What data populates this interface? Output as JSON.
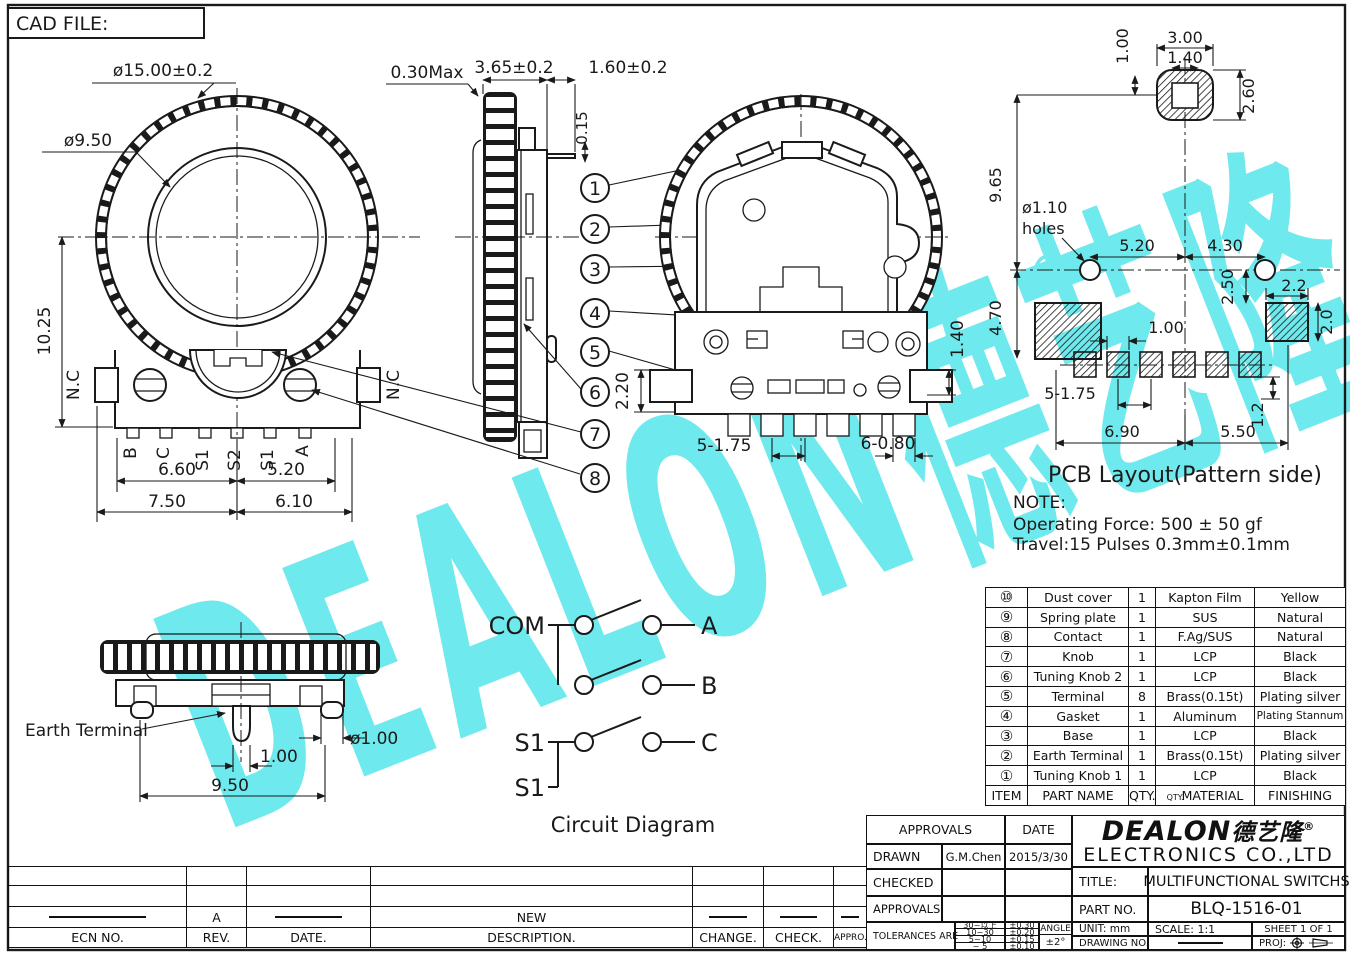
{
  "sheet": {
    "cad_file": "CAD FILE:"
  },
  "watermark": {
    "text": "DEALON德艺隆",
    "registered": "®",
    "color": "#6ee9ed"
  },
  "front_view": {
    "dia_outer": "ø15.00±0.2",
    "dia_inner": "ø9.50",
    "dim_height": "10.25",
    "nc_left": "N.C",
    "nc_right": "N.C",
    "terminals": [
      "B",
      "C",
      "S1",
      "S2",
      "S1",
      "A"
    ],
    "dim_b_left": "6.60",
    "dim_b_right": "5.20",
    "dim_b2_left": "7.50",
    "dim_b2_right": "6.10"
  },
  "side_view": {
    "dim_knob_gap": "0.30Max",
    "dim_thickness": "3.65±0.2",
    "dim_pin_len": "1.60±0.2",
    "dim_pin_off": "0.15"
  },
  "callouts": {
    "c1": "1",
    "c2": "2",
    "c3": "3",
    "c4": "4",
    "c5": "5",
    "c6": "6",
    "c7": "7",
    "c8": "8"
  },
  "back_view": {
    "dim_block": "2.20",
    "dim_pin": "1.40",
    "dim_pitch": "5-1.75",
    "dim_pad": "6-0.80"
  },
  "pcb": {
    "title": "PCB Layout(Pattern side)",
    "dim_shaft_off": "1.00",
    "dim_pad_w": "3.00",
    "dim_hole_w": "1.40",
    "dim_pad_h": "2.60",
    "dim_span_v": "9.65",
    "hole_label_1": "ø1.10",
    "hole_label_2": "holes",
    "dim_hole_l": "5.20",
    "dim_hole_r": "4.30",
    "dim_corner_v": "2.50",
    "dim_corner_w": "2.2",
    "dim_corner_h": "2.0",
    "dim_left_v": "4.70",
    "dim_gap": "1.00",
    "dim_pitch": "5-1.75",
    "dim_edge": "1.2",
    "dim_bot_l": "6.90",
    "dim_bot_r": "5.50"
  },
  "note": {
    "title": "NOTE:",
    "line1": "Operating Force: 500 ± 50 gf",
    "line2": "Travel:15 Pulses 0.3mm±0.1mm"
  },
  "wheel_view": {
    "label": "Earth Terminal",
    "dim_pin_dia": "ø1.00",
    "dim_pin_w": "1.00",
    "dim_span": "9.50"
  },
  "circuit": {
    "com": "COM",
    "a": "A",
    "b": "B",
    "c": "C",
    "s1_top": "S1",
    "s1_bot": "S1",
    "title": "Circuit Diagram"
  },
  "parts_table": {
    "headers": {
      "item": "ITEM",
      "part": "PART NAME",
      "qty": "QTY.",
      "qty_ghost": "QTY.",
      "material": "MATERIAL",
      "finishing": "FINISHING"
    },
    "rows": [
      {
        "item": "⑩",
        "part": "Dust cover",
        "qty": "1",
        "material": "Kapton Film",
        "finishing": "Yellow"
      },
      {
        "item": "⑨",
        "part": "Spring plate",
        "qty": "1",
        "material": "SUS",
        "finishing": "Natural"
      },
      {
        "item": "⑧",
        "part": "Contact",
        "qty": "1",
        "material": "F.Ag/SUS",
        "finishing": "Natural"
      },
      {
        "item": "⑦",
        "part": "Knob",
        "qty": "1",
        "material": "LCP",
        "finishing": "Black"
      },
      {
        "item": "⑥",
        "part": "Tuning Knob 2",
        "qty": "1",
        "material": "LCP",
        "finishing": "Black"
      },
      {
        "item": "⑤",
        "part": "Terminal",
        "qty": "8",
        "material": "Brass(0.15t)",
        "finishing": "Plating silver"
      },
      {
        "item": "④",
        "part": "Gasket",
        "qty": "1",
        "material": "Aluminum",
        "finishing": "Plating Stannum"
      },
      {
        "item": "③",
        "part": "Base",
        "qty": "1",
        "material": "LCP",
        "finishing": "Black"
      },
      {
        "item": "②",
        "part": "Earth Terminal",
        "qty": "1",
        "material": "Brass(0.15t)",
        "finishing": "Plating silver"
      },
      {
        "item": "①",
        "part": "Tuning Knob 1",
        "qty": "1",
        "material": "LCP",
        "finishing": "Black"
      }
    ]
  },
  "title_block": {
    "approvals": "APPROVALS",
    "date": "DATE",
    "drawn": "DRAWN",
    "drawn_by": "G.M.Chen",
    "drawn_date": "2015/3/30",
    "checked": "CHECKED",
    "approvals2": "APPROVALS",
    "tolerances": "TOLERANCES ARE",
    "tol": [
      {
        "range": "30~以上",
        "val": "±0.30"
      },
      {
        "range": "10~30",
        "val": "±0.20"
      },
      {
        "range": "5~10",
        "val": "±0.15"
      },
      {
        "range": "~ 5",
        "val": "±0.10"
      }
    ],
    "angle": "ANGLE",
    "angle_val": "±2°",
    "logo": "DEALON",
    "logo_cn": "德艺隆",
    "logo_r": "®",
    "company": "ELECTRONICS CO.,LTD",
    "title_label": "TITLE:",
    "title_value": "MULTIFUNCTIONAL SWITCHS",
    "part_label": "PART NO.",
    "part_value": "BLQ-1516-01",
    "unit": "UNIT: mm",
    "scale": "SCALE: 1:1",
    "sheet": "SHEET 1 OF 1",
    "drawing_label": "DRAWING NO.",
    "proj_label": "PROJ:"
  },
  "rev_table": {
    "headers": [
      "ECN NO.",
      "REV.",
      "DATE.",
      "DESCRIPTION.",
      "CHANGE.",
      "CHECK.",
      "APPRO."
    ],
    "rev": "A",
    "description": "NEW"
  }
}
